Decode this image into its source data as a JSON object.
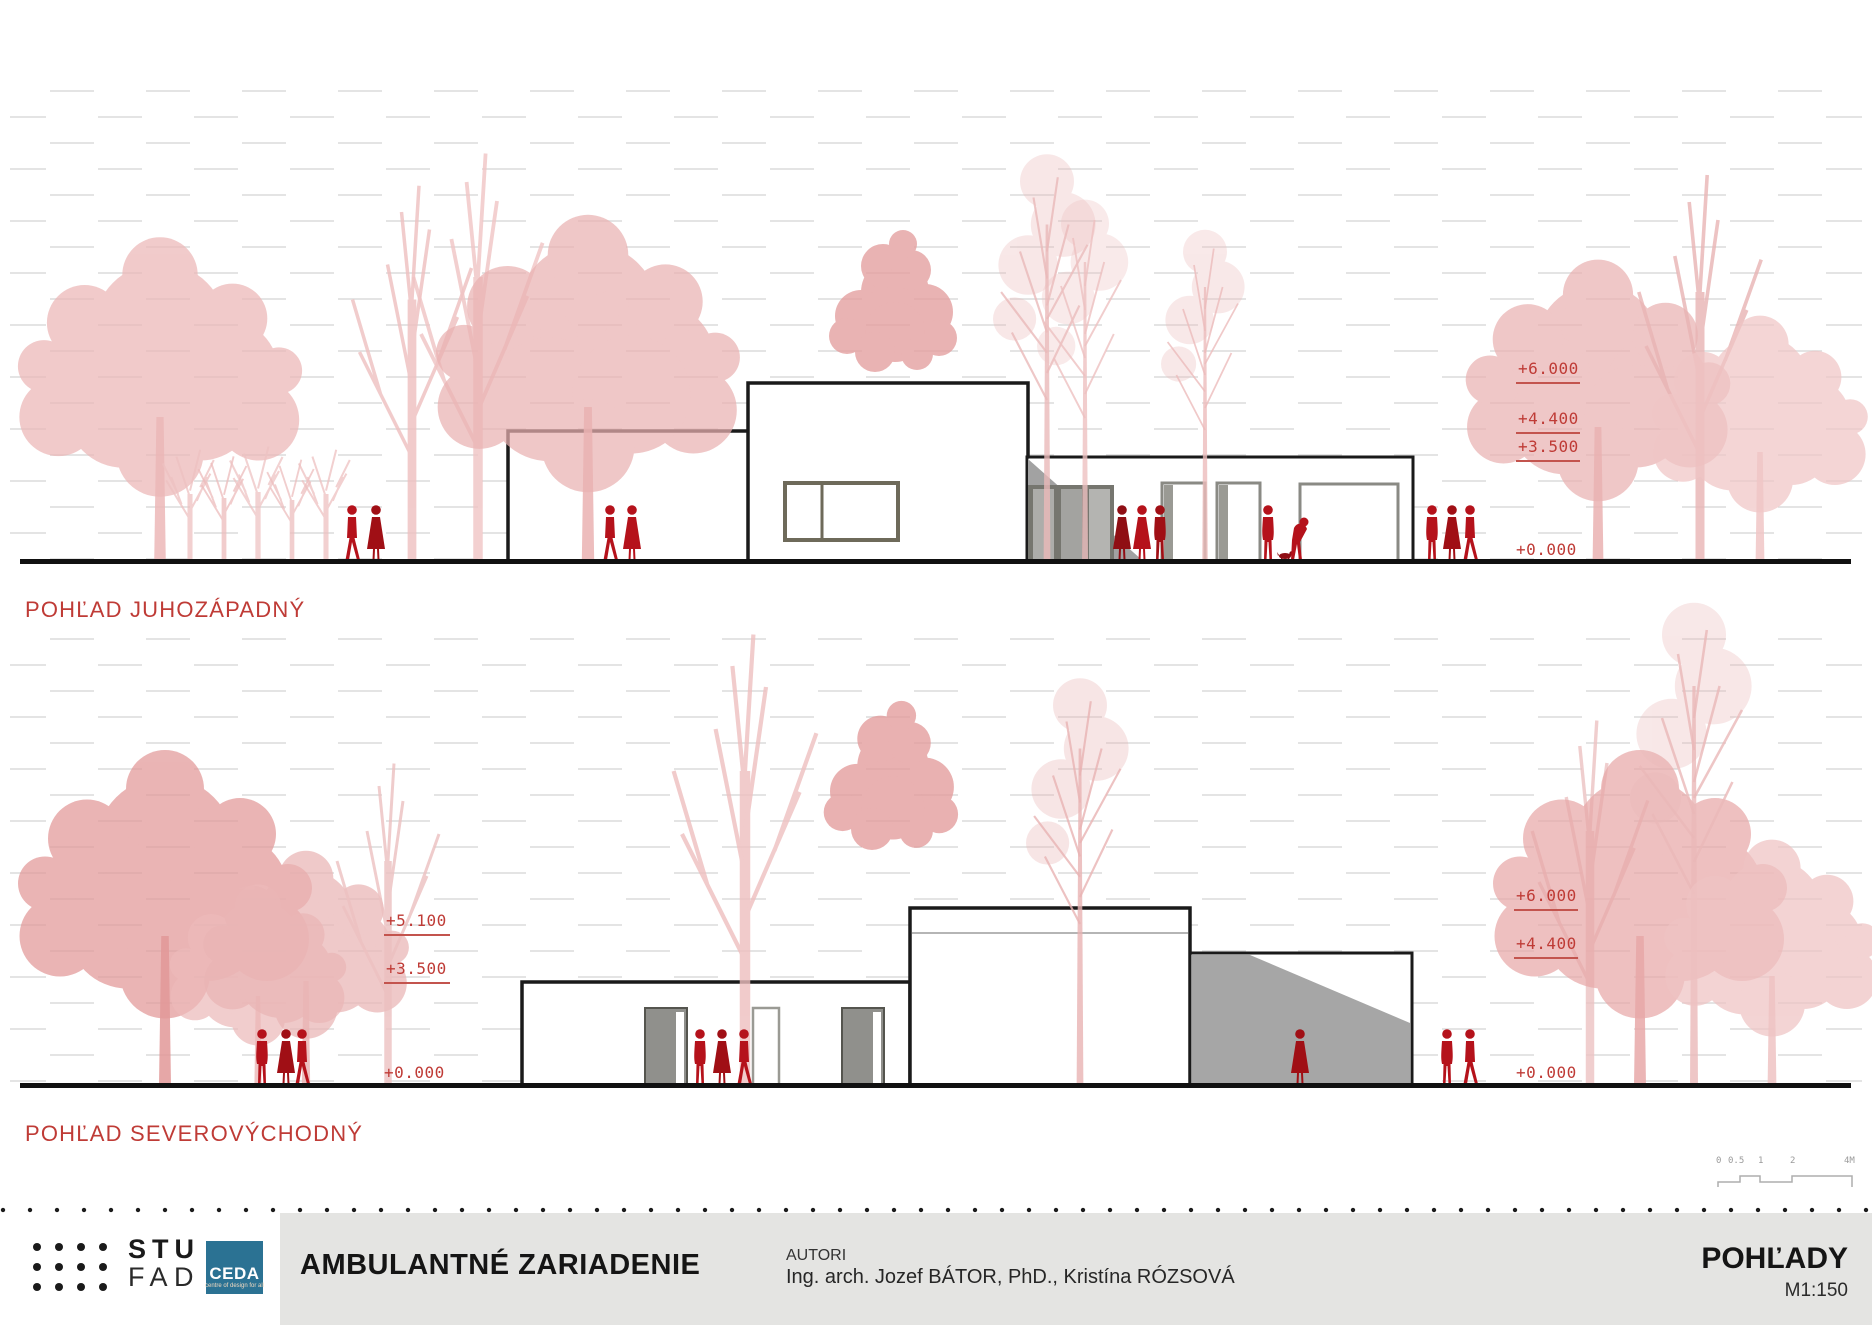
{
  "colors": {
    "accent_red": "#bf3b36",
    "figure_red": "#b5121b",
    "tree_pink": "#eab4b4",
    "shade_gray": "#a6a6a6",
    "panel_gray": "#e4e4e2",
    "ceda_blue": "#2b7293",
    "line_black": "#1a1a1a"
  },
  "elevations": {
    "top": {
      "title": "POHĽAD JUHOZÁPADNÝ",
      "markers": {
        "m1": "+6.000",
        "m2": "+4.400",
        "m3": "+3.500",
        "ground": "+0.000"
      }
    },
    "bottom": {
      "title": "POHĽAD SEVEROVÝCHODNÝ",
      "left_markers": {
        "m1": "+5.100",
        "m2": "+3.500",
        "ground": "+0.000"
      },
      "right_markers": {
        "m1": "+6.000",
        "m2": "+4.400",
        "ground": "+0.000"
      }
    }
  },
  "scalebar": {
    "labels": [
      "0",
      "0.5",
      "1",
      "2",
      "4M"
    ]
  },
  "titleblock": {
    "stu": "STU",
    "fad": "FAD",
    "ceda": "CEDA",
    "ceda_sub": "centre of design for all",
    "project_title": "AMBULANTNÉ ZARIADENIE",
    "authors_label": "AUTORI",
    "authors": "Ing. arch. Jozef BÁTOR, PhD., Kristína RÓZSOVÁ",
    "sheet_title": "POHĽADY",
    "scale": "M1:150"
  }
}
